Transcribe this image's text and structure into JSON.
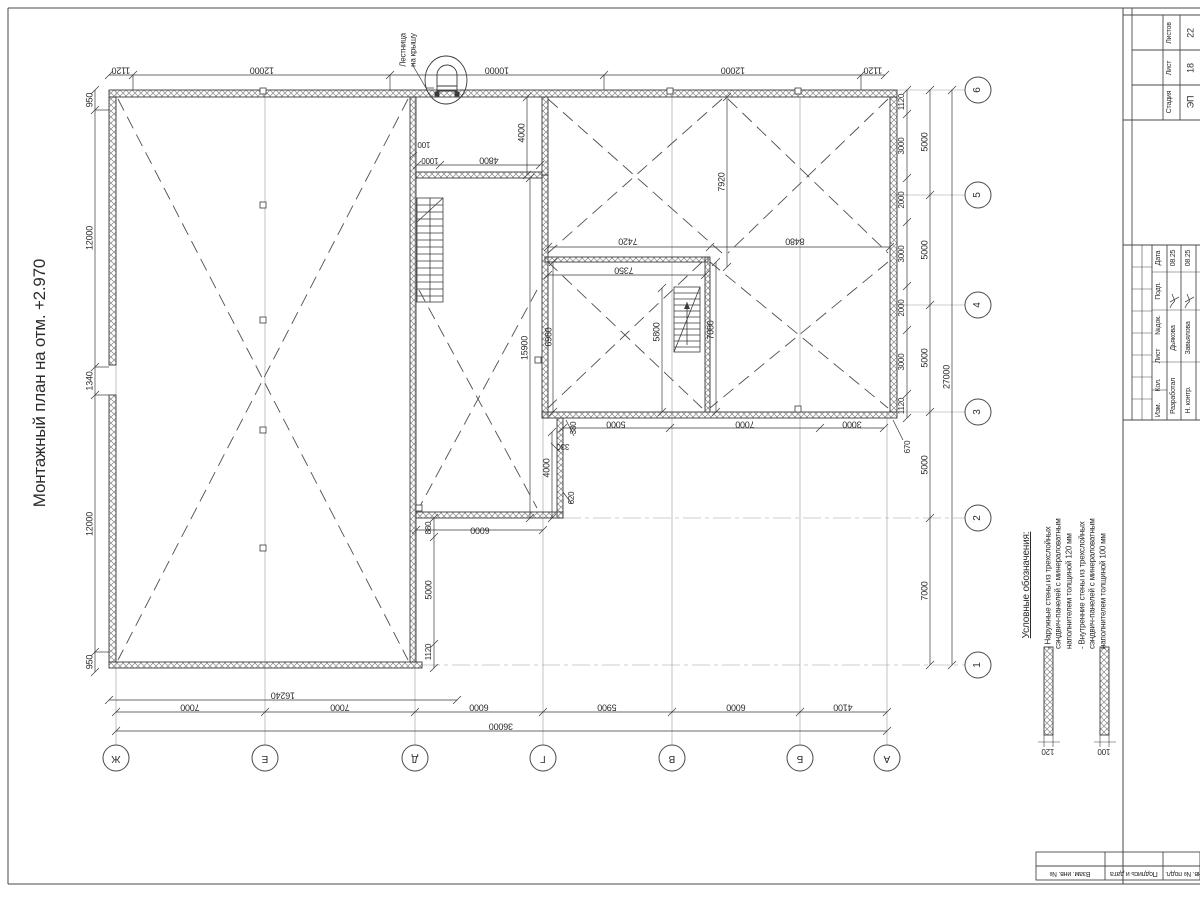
{
  "title": "Монтажный план на отм. +2.970",
  "axes": {
    "bottom": [
      "Ж",
      "Е",
      "Д",
      "Г",
      "В",
      "Б",
      "А"
    ],
    "right": [
      "6",
      "5",
      "4",
      "3",
      "2",
      "1"
    ]
  },
  "legend": {
    "header": "Условные обозначения:",
    "items": [
      {
        "text": "- Наружные стены из трехслойных\nсэндвич-панелей с минераловатным\nнаполнителем толщиной 120 мм",
        "thickness": "120"
      },
      {
        "text": "- Внутренние стены из трехслойных\nсэндвич-панелей с минераловатным\nнаполнителем толщиной 100 мм",
        "thickness": "100"
      }
    ]
  },
  "stamp": {
    "stage_label": "Стадия",
    "stage": "ЭП",
    "sheet_label": "Лист",
    "sheet": "18",
    "total_label": "Листов",
    "total": "22",
    "header_cells": [
      "Дата",
      "Подп.",
      "№док.",
      "Лист",
      "Кол.",
      "Изм."
    ],
    "rows": [
      {
        "role": "Разработал",
        "name": "Дьякова",
        "date": "08.25"
      },
      {
        "role": "Н. контр.",
        "name": "Завьялова",
        "date": "08.25"
      }
    ],
    "frame_labels": [
      "Взам. инв. №",
      "Подпись и дата",
      "Инв. № подл."
    ]
  },
  "labels": [
    {
      "x": 408,
      "y": 50,
      "r": -90,
      "t": "Лестница\nна крышу",
      "s": 8,
      "n": "roof-ladder-label"
    },
    {
      "x": 121,
      "y": 70,
      "r": 180,
      "t": "1120"
    },
    {
      "x": 262,
      "y": 70,
      "r": 180,
      "t": "12000"
    },
    {
      "x": 497,
      "y": 70,
      "r": 180,
      "t": "10000"
    },
    {
      "x": 733,
      "y": 70,
      "r": 180,
      "t": "12000"
    },
    {
      "x": 873,
      "y": 70,
      "r": 180,
      "t": "1120"
    },
    {
      "x": 90,
      "y": 100,
      "r": -90,
      "t": "950"
    },
    {
      "x": 90,
      "y": 238,
      "r": -90,
      "t": "12000"
    },
    {
      "x": 90,
      "y": 381,
      "r": -90,
      "t": "1340"
    },
    {
      "x": 90,
      "y": 524,
      "r": -90,
      "t": "12000"
    },
    {
      "x": 90,
      "y": 662,
      "r": -90,
      "t": "950"
    },
    {
      "x": 283,
      "y": 695,
      "r": 180,
      "t": "16240"
    },
    {
      "x": 190,
      "y": 707,
      "r": 180,
      "t": "7000"
    },
    {
      "x": 340,
      "y": 707,
      "r": 180,
      "t": "7000"
    },
    {
      "x": 479,
      "y": 707,
      "r": 180,
      "t": "6000"
    },
    {
      "x": 607,
      "y": 707,
      "r": 180,
      "t": "5900"
    },
    {
      "x": 736,
      "y": 707,
      "r": 180,
      "t": "6000"
    },
    {
      "x": 843,
      "y": 707,
      "r": 180,
      "t": "4100"
    },
    {
      "x": 501,
      "y": 726,
      "r": 180,
      "t": "36000"
    },
    {
      "x": 902,
      "y": 102,
      "r": -90,
      "t": "1120",
      "s": 8
    },
    {
      "x": 902,
      "y": 146,
      "r": -90,
      "t": "3000",
      "s": 8
    },
    {
      "x": 902,
      "y": 200,
      "r": -90,
      "t": "2000",
      "s": 8
    },
    {
      "x": 902,
      "y": 254,
      "r": -90,
      "t": "3000",
      "s": 8
    },
    {
      "x": 902,
      "y": 308,
      "r": -90,
      "t": "2000",
      "s": 8
    },
    {
      "x": 902,
      "y": 362,
      "r": -90,
      "t": "3000",
      "s": 8
    },
    {
      "x": 902,
      "y": 406,
      "r": -90,
      "t": "1120",
      "s": 8
    },
    {
      "x": 925,
      "y": 142,
      "r": -90,
      "t": "5000"
    },
    {
      "x": 925,
      "y": 250,
      "r": -90,
      "t": "5000"
    },
    {
      "x": 925,
      "y": 358,
      "r": -90,
      "t": "5000"
    },
    {
      "x": 925,
      "y": 465,
      "r": -90,
      "t": "5000"
    },
    {
      "x": 925,
      "y": 591,
      "r": -90,
      "t": "7000"
    },
    {
      "x": 947,
      "y": 377,
      "r": -90,
      "t": "27000"
    },
    {
      "x": 908,
      "y": 447,
      "r": -90,
      "t": "670",
      "s": 8
    },
    {
      "x": 424,
      "y": 144,
      "r": 180,
      "t": "100",
      "s": 8
    },
    {
      "x": 430,
      "y": 160,
      "r": 180,
      "t": "1000",
      "s": 8
    },
    {
      "x": 489,
      "y": 160,
      "r": 180,
      "t": "4800"
    },
    {
      "x": 522,
      "y": 133,
      "r": -90,
      "t": "4000"
    },
    {
      "x": 525,
      "y": 348,
      "r": -90,
      "t": "15900"
    },
    {
      "x": 549,
      "y": 337,
      "r": -90,
      "t": "6980"
    },
    {
      "x": 624,
      "y": 270,
      "r": 180,
      "t": "7350"
    },
    {
      "x": 628,
      "y": 241,
      "r": 180,
      "t": "7420"
    },
    {
      "x": 795,
      "y": 241,
      "r": 180,
      "t": "8480"
    },
    {
      "x": 722,
      "y": 182,
      "r": -90,
      "t": "7920"
    },
    {
      "x": 657,
      "y": 332,
      "r": -90,
      "t": "5800"
    },
    {
      "x": 711,
      "y": 330,
      "r": -90,
      "t": "7080"
    },
    {
      "x": 574,
      "y": 428,
      "r": -90,
      "t": "380",
      "s": 8
    },
    {
      "x": 616,
      "y": 424,
      "r": 180,
      "t": "5000"
    },
    {
      "x": 563,
      "y": 446,
      "r": 180,
      "t": "330",
      "s": 8
    },
    {
      "x": 547,
      "y": 468,
      "r": -90,
      "t": "4000"
    },
    {
      "x": 572,
      "y": 498,
      "r": -90,
      "t": "620",
      "s": 8
    },
    {
      "x": 745,
      "y": 424,
      "r": 180,
      "t": "7000"
    },
    {
      "x": 852,
      "y": 424,
      "r": 180,
      "t": "3000"
    },
    {
      "x": 480,
      "y": 530,
      "r": 180,
      "t": "6000"
    },
    {
      "x": 429,
      "y": 528,
      "r": -90,
      "t": "880",
      "s": 8
    },
    {
      "x": 429,
      "y": 590,
      "r": -90,
      "t": "5000"
    },
    {
      "x": 429,
      "y": 652,
      "r": -90,
      "t": "1120",
      "s": 8
    },
    {
      "x": 116,
      "y": 758,
      "r": 180,
      "t": "Ж",
      "s": 10,
      "n": "axis-label"
    },
    {
      "x": 265,
      "y": 758,
      "r": 180,
      "t": "Е",
      "s": 10,
      "n": "axis-label"
    },
    {
      "x": 415,
      "y": 758,
      "r": 180,
      "t": "Д",
      "s": 10,
      "n": "axis-label"
    },
    {
      "x": 543,
      "y": 758,
      "r": 180,
      "t": "Г",
      "s": 10,
      "n": "axis-label"
    },
    {
      "x": 672,
      "y": 758,
      "r": 180,
      "t": "В",
      "s": 10,
      "n": "axis-label"
    },
    {
      "x": 800,
      "y": 758,
      "r": 180,
      "t": "Б",
      "s": 10,
      "n": "axis-label"
    },
    {
      "x": 887,
      "y": 758,
      "r": 180,
      "t": "А",
      "s": 10,
      "n": "axis-label"
    },
    {
      "x": 978,
      "y": 90,
      "r": -90,
      "t": "6",
      "s": 10,
      "n": "axis-label"
    },
    {
      "x": 978,
      "y": 195,
      "r": -90,
      "t": "5",
      "s": 10,
      "n": "axis-label"
    },
    {
      "x": 978,
      "y": 305,
      "r": -90,
      "t": "4",
      "s": 10,
      "n": "axis-label"
    },
    {
      "x": 978,
      "y": 412,
      "r": -90,
      "t": "3",
      "s": 10,
      "n": "axis-label"
    },
    {
      "x": 978,
      "y": 518,
      "r": -90,
      "t": "2",
      "s": 10,
      "n": "axis-label"
    },
    {
      "x": 978,
      "y": 665,
      "r": -90,
      "t": "1",
      "s": 10,
      "n": "axis-label"
    }
  ]
}
